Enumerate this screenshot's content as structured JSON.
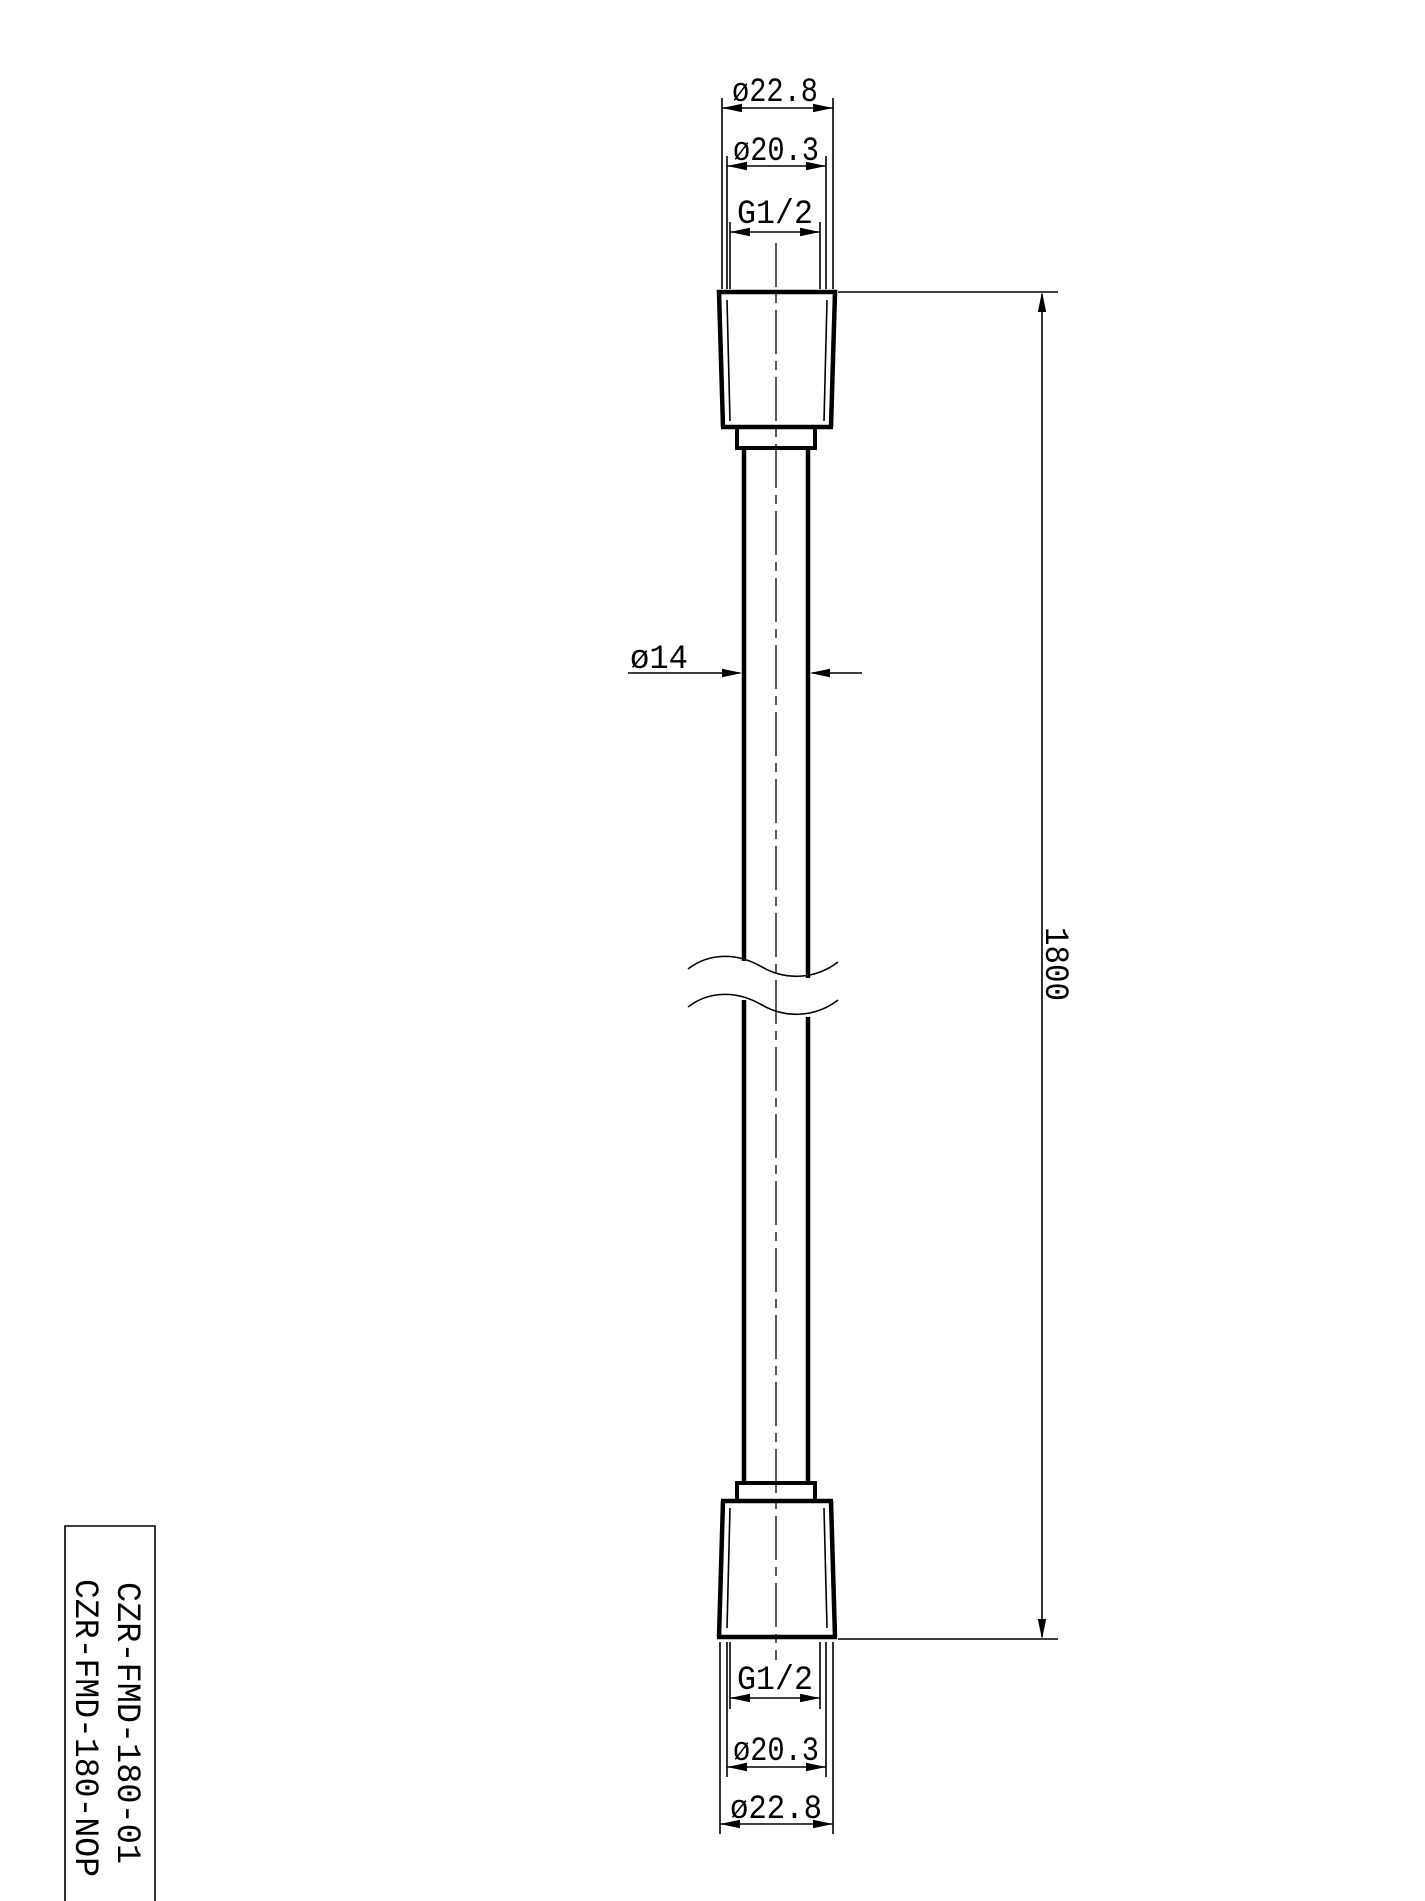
{
  "page": {
    "background": "#ffffff",
    "ink": "#000000",
    "kind": "technical-drawing-shower-hose"
  },
  "labels": {
    "top": {
      "outer_diameter": "ø22.8",
      "mid_diameter": "ø20.3",
      "thread": "G1/2"
    },
    "hose": {
      "diameter": "ø14"
    },
    "length": {
      "value": "1800"
    },
    "bottom": {
      "thread": "G1/2",
      "mid_diameter": "ø20.3",
      "outer_diameter": "ø22.8"
    },
    "title_block": {
      "line1": "CZR-FMD-180-01",
      "line2": "CZR-FMD-180-NOP"
    }
  }
}
